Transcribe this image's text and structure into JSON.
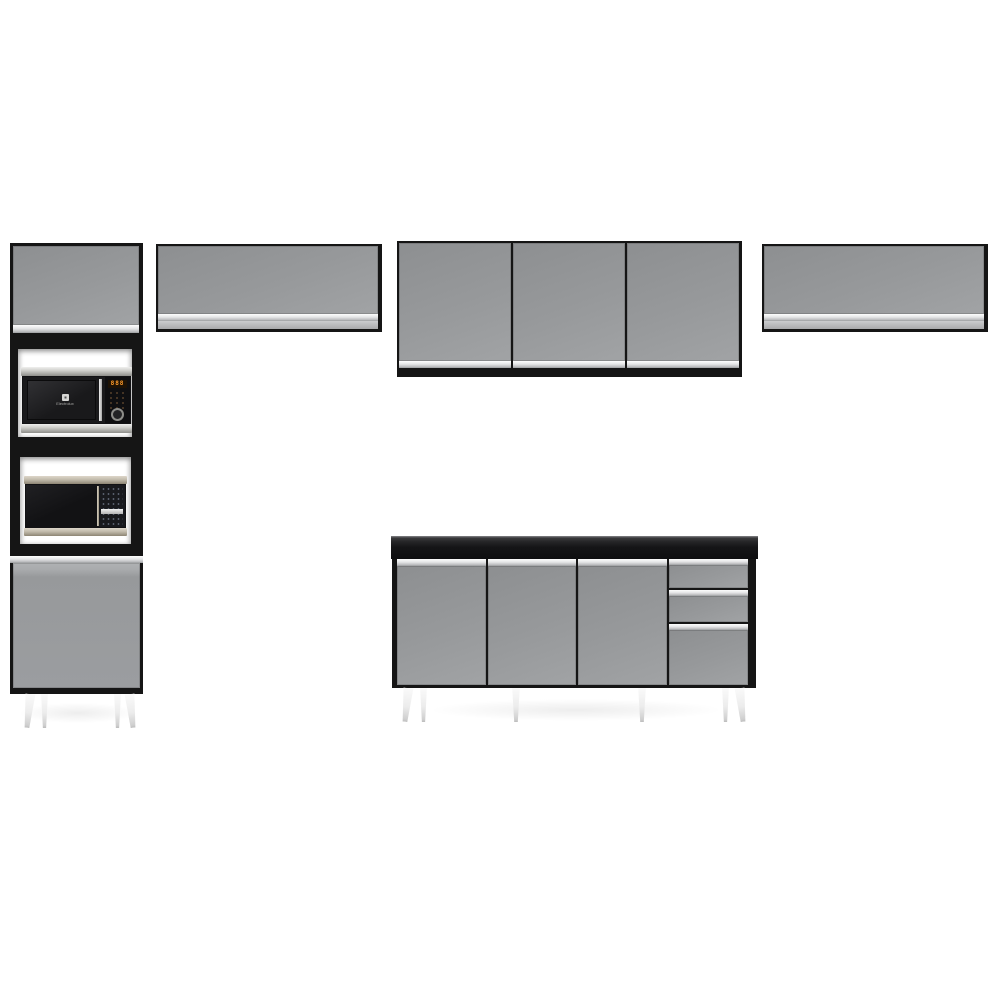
{
  "scene": {
    "background_color": "#ffffff",
    "subject": "Gray and black modular kitchen set: tall microwave tower cabinet, three wall cabinets and a base counter cabinet on white tapered feet"
  },
  "palette": {
    "scene_bg": "#ffffff",
    "frame_black": "#151515",
    "door_gray": "#97999b",
    "door_gray_dark": "#8d8f91",
    "door_gray_light": "#a1a3a5",
    "handle_silver": "#e4e5e6",
    "handle_silver_deep": "#bcbdbf",
    "niche_white": "#ffffff",
    "countertop_top": "#242426",
    "steel_light": "#cfcfcb",
    "steel_dark": "#8e8e8a",
    "champagne_light": "#c2bbac",
    "champagne_dark": "#8d8574",
    "mw_display_orange": "#ff9b2a",
    "mw_button_gray": "#5d6472",
    "leg_white": "#ececec",
    "floor_shadow": "rgba(0,0,0,0.07)"
  },
  "tower_cabinet": {
    "doors": 2,
    "microwave_niches": 2,
    "upper_microwave": {
      "brand": "Electrolux",
      "display_text": "888"
    }
  },
  "wall_cabinets": {
    "left": {
      "doors": 1
    },
    "center": {
      "doors": 3
    },
    "right": {
      "doors": 1
    }
  },
  "base_cabinet": {
    "doors": 3,
    "drawers": 3
  }
}
